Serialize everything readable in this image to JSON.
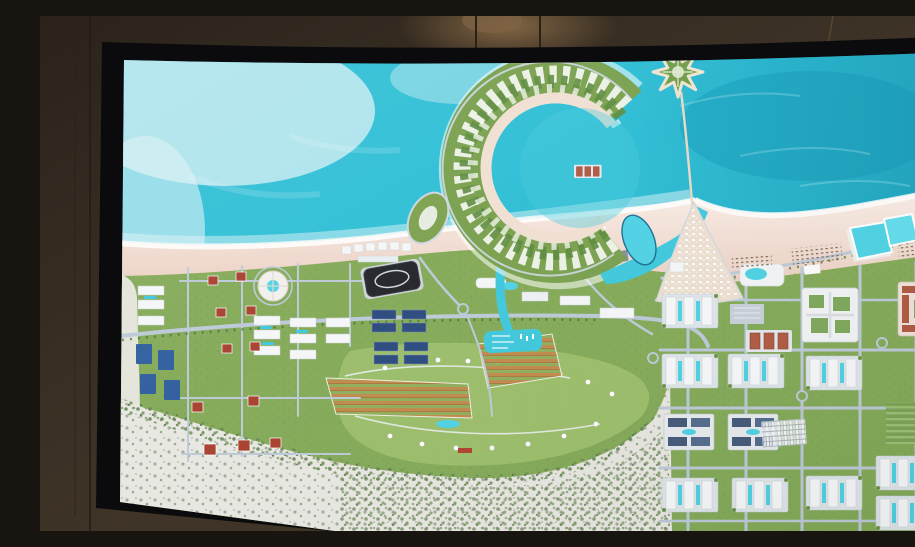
{
  "scene": {
    "description": "Photograph of a wall-mounted TV screen displaying an aerial masterplan rendering of a coastal resort city with a crescent-shaped island, star island, beaches, lagoons and residential districts",
    "display_type": "tv-screen",
    "visible_text": ""
  },
  "colors": {
    "wall": "#3d3227",
    "wall_dark": "#261f19",
    "bezel": "#0b0b0d",
    "sea": "#2fbfd6",
    "sea_deep": "#1091b0",
    "sea_light": "#cfeef2",
    "beach": "#f0dcd1",
    "foam": "#ffffff",
    "land": "#84aa58",
    "land_light": "#9cbf6c",
    "crescent": "#79a04e",
    "desert": "#e9e7e1",
    "road": "#bcc9d7",
    "pool": "#4ed2e4",
    "canal": "#3fc8dc",
    "building_white": "#f4f6f7",
    "building_blue": "#2f5e9e",
    "building_red": "#a8402f",
    "roof_dark": "#44597a",
    "stadium": "#23262b",
    "crop_orange": "#c18a4c",
    "tree": "#3f6b33",
    "medina_sand": "#ecdfd0"
  },
  "regions": {
    "sea": "open sea",
    "crescent_island": "crescent island resort",
    "star_island": "star island",
    "causeway": "causeway bridge",
    "old_town": "old town village",
    "beach_lagoons": "beach lagoon pools",
    "marina": "marina canal",
    "stadium": "sports hall",
    "round_resort": "circular resort",
    "residential_grid": "residential district",
    "golf_park": "villa park",
    "desert": "desert scrub"
  }
}
